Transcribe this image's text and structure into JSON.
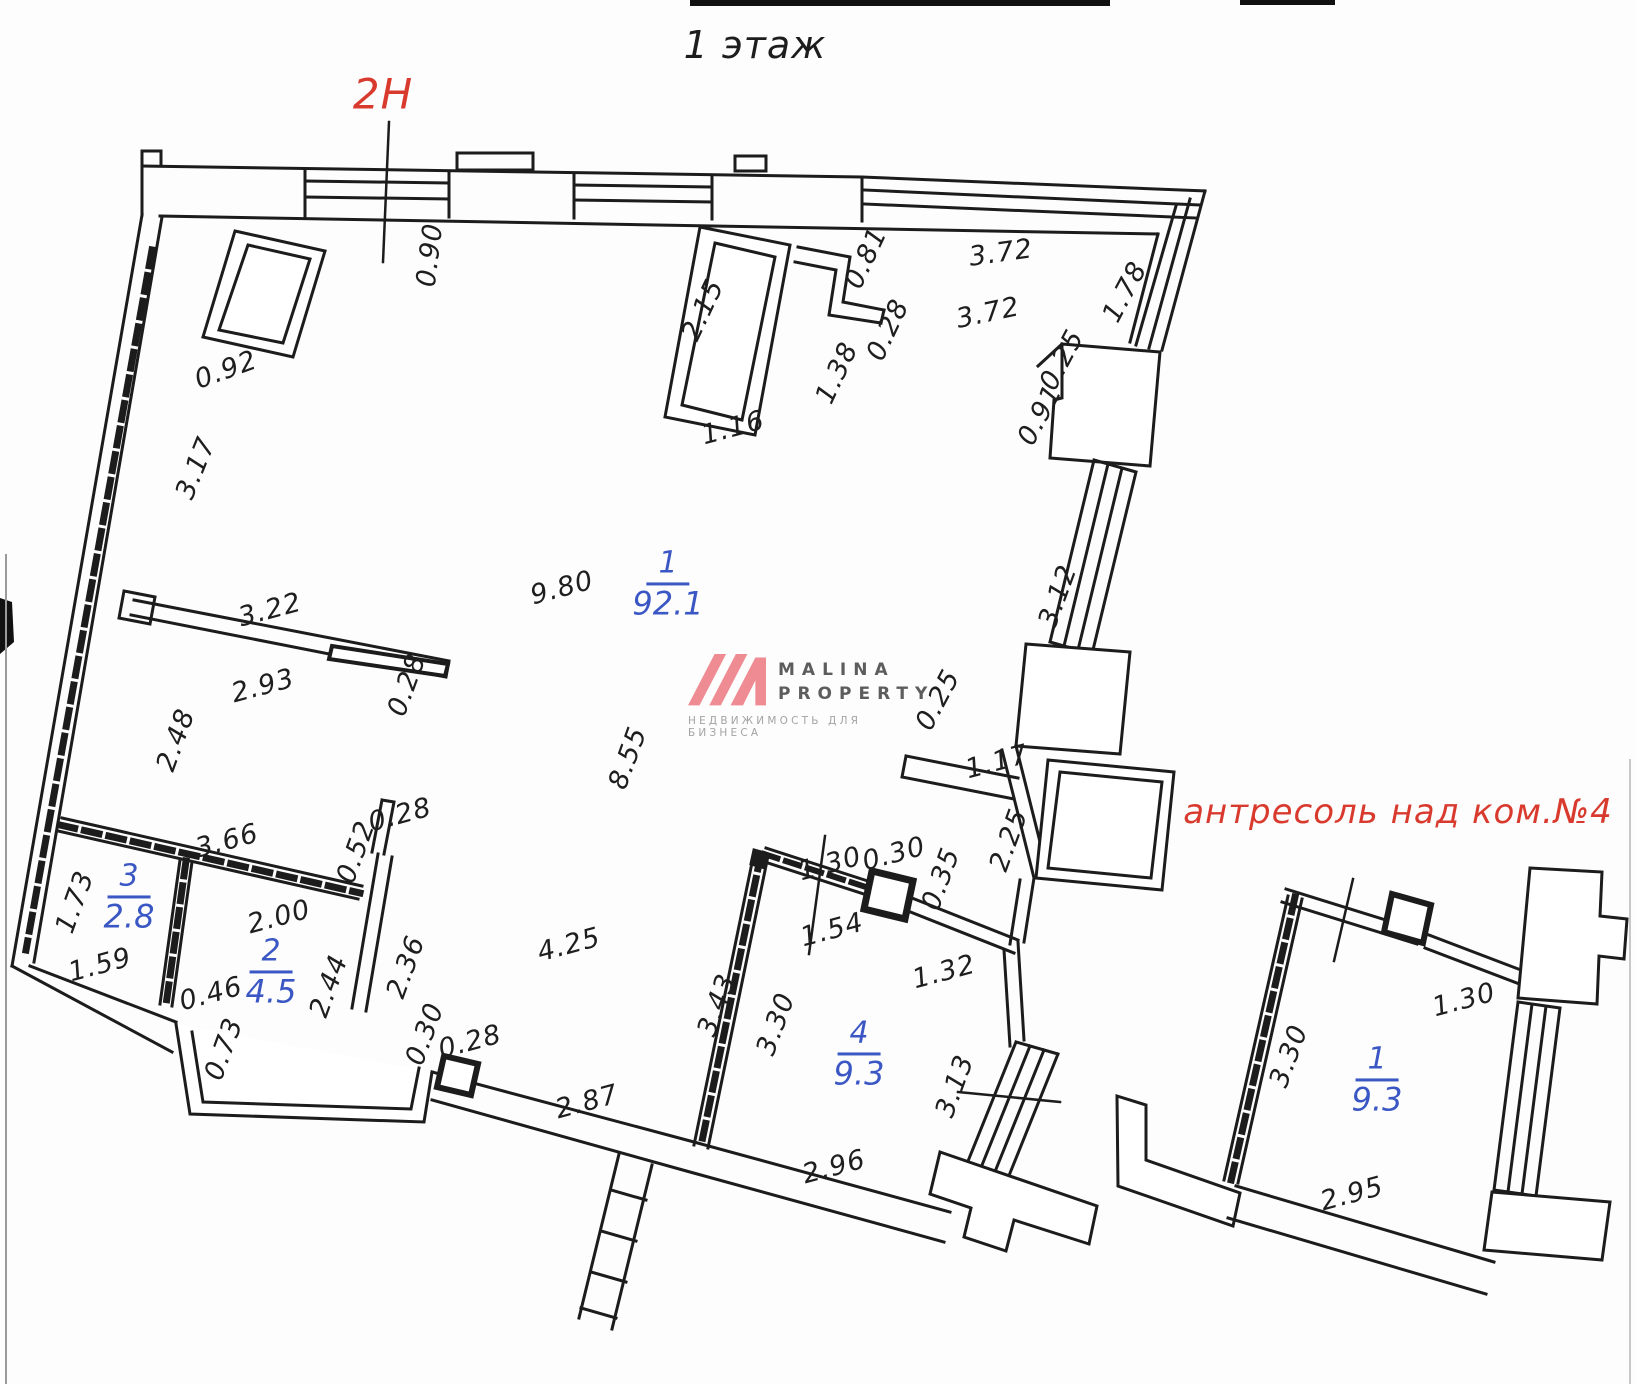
{
  "title": "1 этаж",
  "zone_label": "2Н",
  "mezzanine_label": "антресоль над ком.№4",
  "watermark": {
    "brand_top": "MALINA",
    "brand_bottom": "PROPERTY",
    "tagline": "НЕДВИЖИМОСТЬ ДЛЯ БИЗНЕСА"
  },
  "colors": {
    "wall": "#1c1c1c",
    "room_label_blue": "#3a57c4",
    "red_label": "#d93a2e",
    "logo_pink": "#ef8b92",
    "logo_gray": "#5d5d5d",
    "tagline_gray": "#a3a3a3"
  },
  "rooms": [
    {
      "number": "1",
      "area": "92.1",
      "x": 668,
      "y": 584
    },
    {
      "number": "3",
      "area": "2.8",
      "x": 129,
      "y": 897
    },
    {
      "number": "2",
      "area": "4.5",
      "x": 271,
      "y": 972
    },
    {
      "number": "4",
      "area": "9.3",
      "x": 859,
      "y": 1054
    },
    {
      "number": "1",
      "area": "9.3",
      "x": 1377,
      "y": 1080
    }
  ],
  "dimensions": [
    {
      "text": "0.90",
      "x": 430,
      "y": 255,
      "r": -83
    },
    {
      "text": "0.92",
      "x": 226,
      "y": 370,
      "r": -20
    },
    {
      "text": "3.17",
      "x": 196,
      "y": 468,
      "r": -68
    },
    {
      "text": "2.15",
      "x": 703,
      "y": 310,
      "r": -65
    },
    {
      "text": "0.81",
      "x": 866,
      "y": 258,
      "r": -65
    },
    {
      "text": "0.28",
      "x": 888,
      "y": 330,
      "r": -65
    },
    {
      "text": "1.38",
      "x": 837,
      "y": 373,
      "r": -65
    },
    {
      "text": "1.16",
      "x": 733,
      "y": 428,
      "r": -15
    },
    {
      "text": "3.72",
      "x": 1001,
      "y": 253,
      "r": -8
    },
    {
      "text": "3.72",
      "x": 988,
      "y": 313,
      "r": -12
    },
    {
      "text": "1.78",
      "x": 1125,
      "y": 292,
      "r": -62
    },
    {
      "text": "0.25",
      "x": 1062,
      "y": 360,
      "r": -62
    },
    {
      "text": "0.91",
      "x": 1040,
      "y": 415,
      "r": -62
    },
    {
      "text": "3.12",
      "x": 1058,
      "y": 596,
      "r": -70
    },
    {
      "text": "9.80",
      "x": 562,
      "y": 588,
      "r": -15
    },
    {
      "text": "3.22",
      "x": 270,
      "y": 610,
      "r": -15
    },
    {
      "text": "2.93",
      "x": 263,
      "y": 686,
      "r": -15
    },
    {
      "text": "0.28",
      "x": 407,
      "y": 685,
      "r": -70
    },
    {
      "text": "2.48",
      "x": 176,
      "y": 740,
      "r": -70
    },
    {
      "text": "8.55",
      "x": 628,
      "y": 758,
      "r": -70
    },
    {
      "text": "0.25",
      "x": 938,
      "y": 700,
      "r": -62
    },
    {
      "text": "1.17",
      "x": 997,
      "y": 762,
      "r": -15
    },
    {
      "text": "2.25",
      "x": 1009,
      "y": 840,
      "r": -70
    },
    {
      "text": "0.28",
      "x": 400,
      "y": 815,
      "r": -15
    },
    {
      "text": "3.66",
      "x": 227,
      "y": 841,
      "r": -15
    },
    {
      "text": "0.52",
      "x": 356,
      "y": 852,
      "r": -70
    },
    {
      "text": "1.73",
      "x": 75,
      "y": 902,
      "r": -70
    },
    {
      "text": "2.00",
      "x": 279,
      "y": 917,
      "r": -15
    },
    {
      "text": "1.59",
      "x": 100,
      "y": 965,
      "r": -15
    },
    {
      "text": "0.46",
      "x": 211,
      "y": 994,
      "r": -15
    },
    {
      "text": "2.44",
      "x": 329,
      "y": 986,
      "r": -70
    },
    {
      "text": "2.36",
      "x": 406,
      "y": 967,
      "r": -70
    },
    {
      "text": "0.73",
      "x": 224,
      "y": 1049,
      "r": -70
    },
    {
      "text": "0.30",
      "x": 425,
      "y": 1034,
      "r": -70
    },
    {
      "text": "0.28",
      "x": 470,
      "y": 1042,
      "r": -15
    },
    {
      "text": "4.25",
      "x": 569,
      "y": 945,
      "r": -15
    },
    {
      "text": "2.87",
      "x": 587,
      "y": 1102,
      "r": -15
    },
    {
      "text": "1.30",
      "x": 830,
      "y": 864,
      "r": -15
    },
    {
      "text": "0.30",
      "x": 894,
      "y": 854,
      "r": -15
    },
    {
      "text": "0.35",
      "x": 941,
      "y": 879,
      "r": -70
    },
    {
      "text": "1.54",
      "x": 832,
      "y": 930,
      "r": -15
    },
    {
      "text": "1.32",
      "x": 944,
      "y": 972,
      "r": -15
    },
    {
      "text": "3.43",
      "x": 717,
      "y": 1005,
      "r": -70
    },
    {
      "text": "3.30",
      "x": 776,
      "y": 1024,
      "r": -70
    },
    {
      "text": "3.13",
      "x": 955,
      "y": 1086,
      "r": -70
    },
    {
      "text": "2.96",
      "x": 834,
      "y": 1167,
      "r": -15
    },
    {
      "text": "1.30",
      "x": 1464,
      "y": 1000,
      "r": -15
    },
    {
      "text": "3.30",
      "x": 1289,
      "y": 1056,
      "r": -70
    },
    {
      "text": "2.95",
      "x": 1352,
      "y": 1194,
      "r": -15
    }
  ]
}
